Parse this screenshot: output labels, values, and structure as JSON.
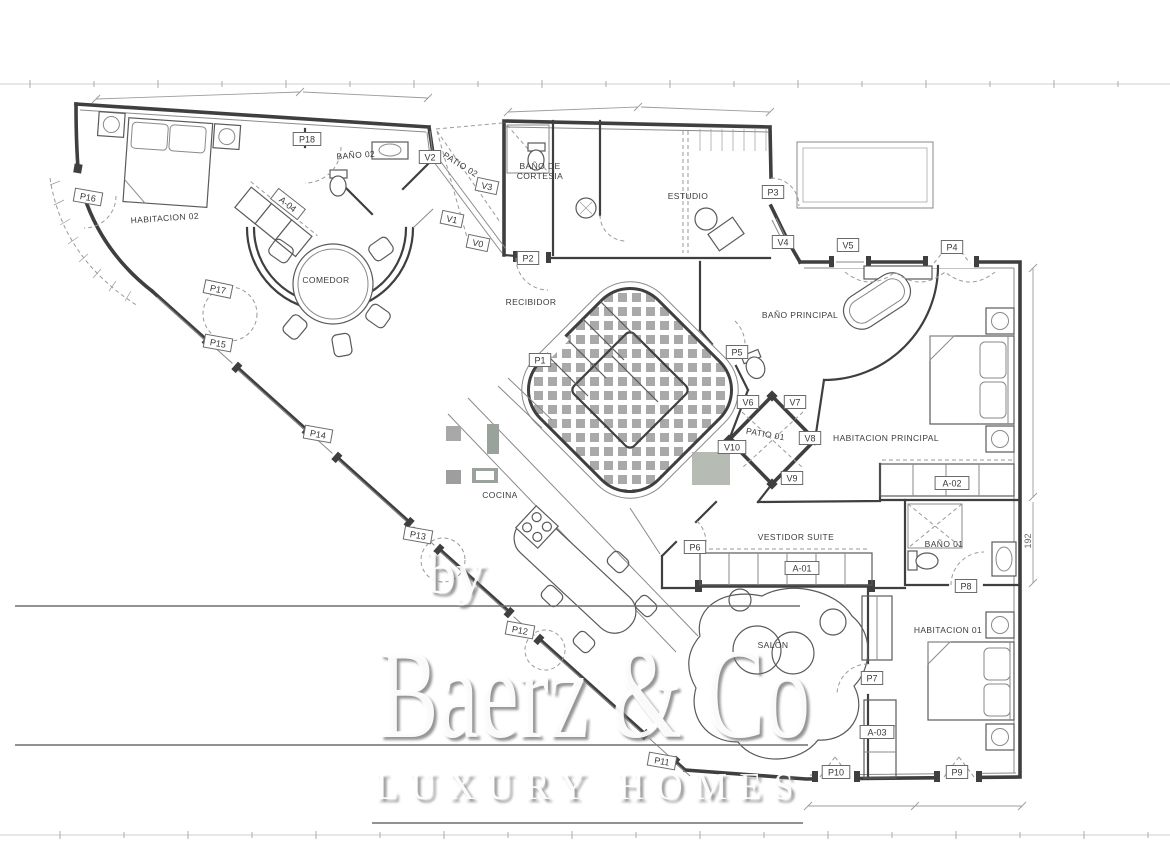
{
  "watermark": {
    "prefix": "by",
    "brand": "Baerz & Co",
    "tagline": "LUXURY HOMES"
  },
  "colors": {
    "wall_color": "#3f3f3f",
    "thin_line_color": "#8a8a8a",
    "tile_color": "#949494",
    "dash_color": "#9a9a9a"
  },
  "rooms": [
    {
      "label": "HABITACION 02",
      "x": 165,
      "y": 221,
      "rotation": -4
    },
    {
      "label": "BAÑO 02",
      "x": 356,
      "y": 158,
      "rotation": -4,
      "size": 7.5
    },
    {
      "label": "COMEDOR",
      "x": 326,
      "y": 283
    },
    {
      "label": "PATIO 02",
      "x": 459,
      "y": 167,
      "rotation": 32,
      "size": 6.5
    },
    {
      "label": "BAÑO DE",
      "x": 540,
      "y": 169,
      "size": 7.5
    },
    {
      "label": "CORTESIA",
      "x": 540,
      "y": 179,
      "size": 7.5
    },
    {
      "label": "ESTUDIO",
      "x": 688,
      "y": 199
    },
    {
      "label": "RECIBIDOR",
      "x": 531,
      "y": 305
    },
    {
      "label": "BAÑO PRINCIPAL",
      "x": 800,
      "y": 318,
      "size": 7.5
    },
    {
      "label": "PATIO 01",
      "x": 765,
      "y": 437,
      "rotation": 10,
      "size": 6.5
    },
    {
      "label": "HABITACION PRINCIPAL",
      "x": 886,
      "y": 441
    },
    {
      "label": "VESTIDOR SUITE",
      "x": 796,
      "y": 540
    },
    {
      "label": "BAÑO 01",
      "x": 944,
      "y": 547,
      "size": 7.5
    },
    {
      "label": "HABITACION 01",
      "x": 948,
      "y": 633
    },
    {
      "label": "COCINA",
      "x": 500,
      "y": 498
    },
    {
      "label": "SALON",
      "x": 773,
      "y": 648,
      "size": 7.5
    }
  ],
  "openings": [
    {
      "label": "P1",
      "x": 540,
      "y": 360
    },
    {
      "label": "P2",
      "x": 528,
      "y": 258
    },
    {
      "label": "P3",
      "x": 773,
      "y": 192
    },
    {
      "label": "P4",
      "x": 952,
      "y": 247
    },
    {
      "label": "P5",
      "x": 737,
      "y": 352
    },
    {
      "label": "P6",
      "x": 695,
      "y": 547
    },
    {
      "label": "P7",
      "x": 872,
      "y": 678
    },
    {
      "label": "P8",
      "x": 966,
      "y": 586
    },
    {
      "label": "P9",
      "x": 957,
      "y": 772
    },
    {
      "label": "P10",
      "x": 836,
      "y": 772
    },
    {
      "label": "P11",
      "x": 662,
      "y": 761,
      "rotation": 10
    },
    {
      "label": "P12",
      "x": 520,
      "y": 630,
      "rotation": 10
    },
    {
      "label": "P13",
      "x": 418,
      "y": 535,
      "rotation": 10
    },
    {
      "label": "P14",
      "x": 318,
      "y": 434,
      "rotation": 10
    },
    {
      "label": "P15",
      "x": 218,
      "y": 343,
      "rotation": 10
    },
    {
      "label": "P16",
      "x": 88,
      "y": 197,
      "rotation": 10
    },
    {
      "label": "P17",
      "x": 218,
      "y": 289,
      "rotation": 12
    },
    {
      "label": "P18",
      "x": 307,
      "y": 139
    },
    {
      "label": "V0",
      "x": 478,
      "y": 243,
      "rotation": 12
    },
    {
      "label": "V1",
      "x": 452,
      "y": 219,
      "rotation": 12
    },
    {
      "label": "V2",
      "x": 430,
      "y": 157
    },
    {
      "label": "V3",
      "x": 487,
      "y": 186,
      "rotation": 12
    },
    {
      "label": "V4",
      "x": 783,
      "y": 242
    },
    {
      "label": "V5",
      "x": 848,
      "y": 245
    },
    {
      "label": "V6",
      "x": 748,
      "y": 402
    },
    {
      "label": "V7",
      "x": 795,
      "y": 402
    },
    {
      "label": "V8",
      "x": 810,
      "y": 438
    },
    {
      "label": "V9",
      "x": 792,
      "y": 478
    },
    {
      "label": "V10",
      "x": 732,
      "y": 447
    },
    {
      "label": "A-01",
      "x": 802,
      "y": 568
    },
    {
      "label": "A-02",
      "x": 952,
      "y": 483
    },
    {
      "label": "A-03",
      "x": 877,
      "y": 732
    },
    {
      "label": "A-04",
      "x": 288,
      "y": 204,
      "rotation": 38
    }
  ],
  "dimension_labels": [
    {
      "text": "192",
      "x": 1031,
      "y": 541,
      "rotation": -90
    }
  ]
}
